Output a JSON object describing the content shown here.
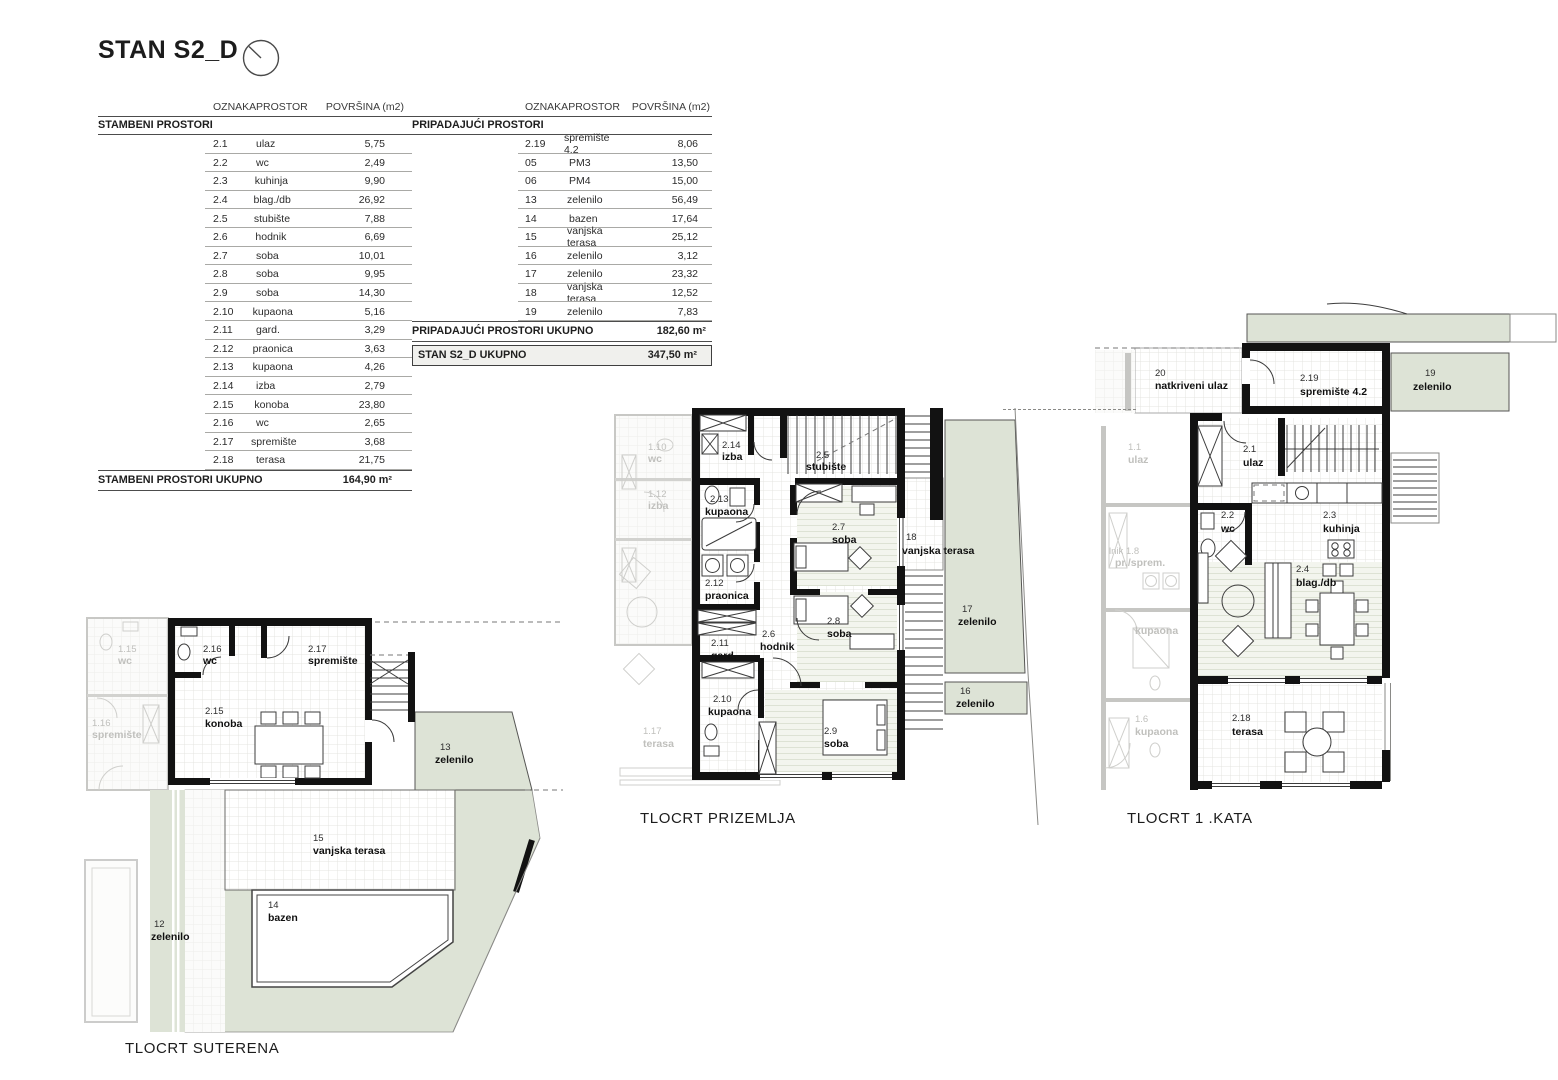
{
  "title": "STAN S2_D",
  "table_headers": {
    "col1": "OZNAKA",
    "col2": "PROSTOR",
    "col3": "POVRŠINA (m2)"
  },
  "left_table": {
    "section": "STAMBENI PROSTORI",
    "rows": [
      {
        "code": "2.1",
        "name": "ulaz",
        "area": "5,75"
      },
      {
        "code": "2.2",
        "name": "wc",
        "area": "2,49"
      },
      {
        "code": "2.3",
        "name": "kuhinja",
        "area": "9,90"
      },
      {
        "code": "2.4",
        "name": "blag./db",
        "area": "26,92"
      },
      {
        "code": "2.5",
        "name": "stubište",
        "area": "7,88"
      },
      {
        "code": "2.6",
        "name": "hodnik",
        "area": "6,69"
      },
      {
        "code": "2.7",
        "name": "soba",
        "area": "10,01"
      },
      {
        "code": "2.8",
        "name": "soba",
        "area": "9,95"
      },
      {
        "code": "2.9",
        "name": "soba",
        "area": "14,30"
      },
      {
        "code": "2.10",
        "name": "kupaona",
        "area": "5,16"
      },
      {
        "code": "2.11",
        "name": "gard.",
        "area": "3,29"
      },
      {
        "code": "2.12",
        "name": "praonica",
        "area": "3,63"
      },
      {
        "code": "2.13",
        "name": "kupaona",
        "area": "4,26"
      },
      {
        "code": "2.14",
        "name": "izba",
        "area": "2,79"
      },
      {
        "code": "2.15",
        "name": "konoba",
        "area": "23,80"
      },
      {
        "code": "2.16",
        "name": "wc",
        "area": "2,65"
      },
      {
        "code": "2.17",
        "name": "spremište",
        "area": "3,68"
      },
      {
        "code": "2.18",
        "name": "terasa",
        "area": "21,75"
      }
    ],
    "total_label": "STAMBENI PROSTORI UKUPNO",
    "total_value": "164,90 m²"
  },
  "right_table": {
    "section": "PRIPADAJUĆI PROSTORI",
    "rows": [
      {
        "code": "2.19",
        "name": "spremište 4.2",
        "area": "8,06"
      },
      {
        "code": "05",
        "name": "PM3",
        "area": "13,50"
      },
      {
        "code": "06",
        "name": "PM4",
        "area": "15,00"
      },
      {
        "code": "13",
        "name": "zelenilo",
        "area": "56,49"
      },
      {
        "code": "14",
        "name": "bazen",
        "area": "17,64"
      },
      {
        "code": "15",
        "name": "vanjska terasa",
        "area": "25,12"
      },
      {
        "code": "16",
        "name": "zelenilo",
        "area": "3,12"
      },
      {
        "code": "17",
        "name": "zelenilo",
        "area": "23,32"
      },
      {
        "code": "18",
        "name": "vanjska terasa",
        "area": "12,52"
      },
      {
        "code": "19",
        "name": "zelenilo",
        "area": "7,83"
      }
    ],
    "total_label": "PRIPADAJUĆI PROSTORI UKUPNO",
    "total_value": "182,60 m²",
    "grand_total_label": "STAN S2_D UKUPNO",
    "grand_total_value": "347,50 m²"
  },
  "plans": {
    "suterena": {
      "caption": "TLOCRT SUTERENA",
      "rooms": [
        {
          "code": "2.16",
          "name": "wc"
        },
        {
          "code": "2.17",
          "name": "spremište"
        },
        {
          "code": "2.15",
          "name": "konoba"
        },
        {
          "code": "13",
          "name": "zelenilo"
        },
        {
          "code": "15",
          "name": "vanjska terasa"
        },
        {
          "code": "14",
          "name": "bazen"
        },
        {
          "code": "12",
          "name": "zelenilo"
        }
      ],
      "faded_rooms": [
        {
          "code": "1.15",
          "name": "wc"
        },
        {
          "code": "1.16",
          "name": "spremište"
        }
      ]
    },
    "prizemlje": {
      "caption": "TLOCRT PRIZEMLJA",
      "rooms": [
        {
          "code": "2.14",
          "name": "izba"
        },
        {
          "code": "2.5",
          "name": "stubište"
        },
        {
          "code": "2.13",
          "name": "kupaona"
        },
        {
          "code": "2.7",
          "name": "soba"
        },
        {
          "code": "2.12",
          "name": "praonica"
        },
        {
          "code": "2.11",
          "name": "gard."
        },
        {
          "code": "2.6",
          "name": "hodnik"
        },
        {
          "code": "2.8",
          "name": "soba"
        },
        {
          "code": "2.10",
          "name": "kupaona"
        },
        {
          "code": "2.9",
          "name": "soba"
        },
        {
          "code": "18",
          "name": "vanjska terasa"
        },
        {
          "code": "17",
          "name": "zelenilo"
        },
        {
          "code": "16",
          "name": "zelenilo"
        }
      ],
      "faded_rooms": [
        {
          "code": "1.10",
          "name": "wc"
        },
        {
          "code": "1.12",
          "name": "izba"
        },
        {
          "code": "1.17",
          "name": "terasa"
        }
      ]
    },
    "kat1": {
      "caption": "TLOCRT 1 .KATA",
      "rooms": [
        {
          "code": "20",
          "name": "natkriveni ulaz"
        },
        {
          "code": "2.19",
          "name": "spremište 4.2"
        },
        {
          "code": "19",
          "name": "zelenilo"
        },
        {
          "code": "2.1",
          "name": "ulaz"
        },
        {
          "code": "2.2",
          "name": "wc"
        },
        {
          "code": "2.3",
          "name": "kuhinja"
        },
        {
          "code": "2.4",
          "name": "blag./db"
        },
        {
          "code": "2.18",
          "name": "terasa"
        }
      ],
      "faded_rooms": [
        {
          "code": "1.1",
          "name": "ulaz"
        },
        {
          "code": "lnik  1.8",
          "name": "pr./sprem."
        },
        {
          "code": "",
          "name": "kupaona"
        },
        {
          "code": "1.6",
          "name": "kupaona"
        }
      ]
    }
  },
  "colors": {
    "plan_green": "#dde3d6",
    "wall_black": "#121212",
    "faded_gray": "#c0c0bd",
    "total_row_bg": "#f0f0ed"
  }
}
